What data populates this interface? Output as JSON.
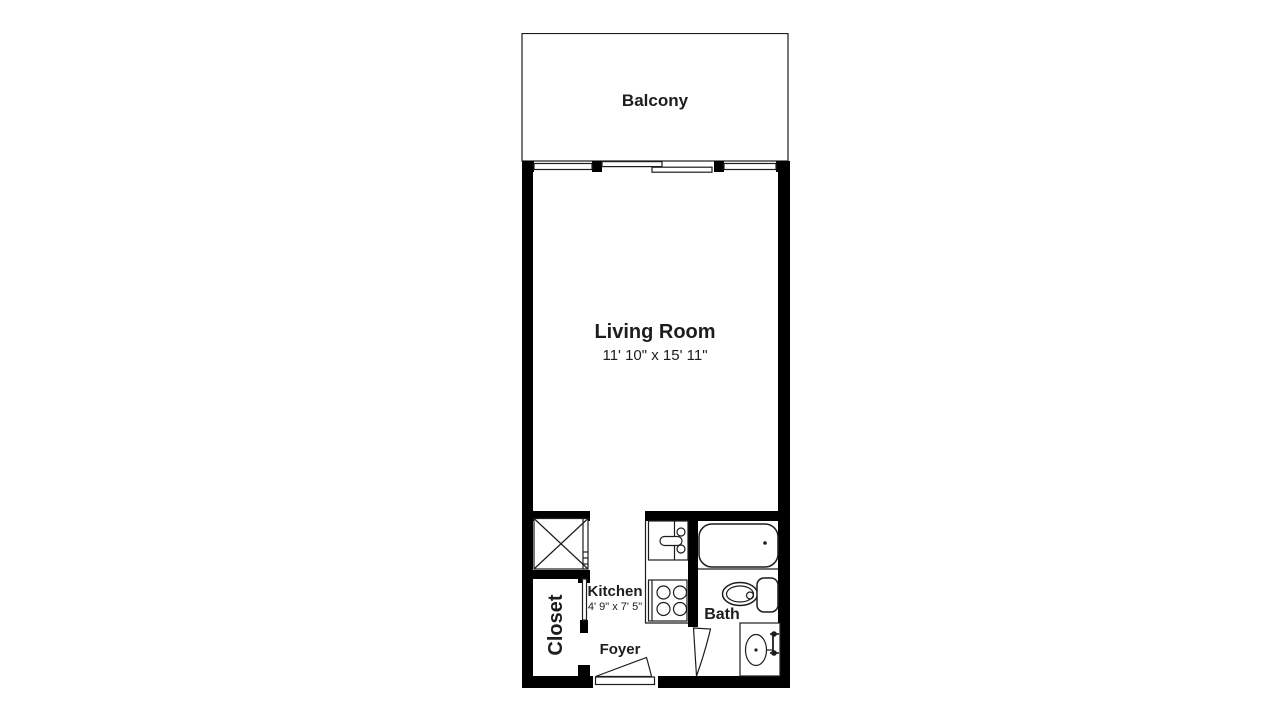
{
  "plan": {
    "title": "Studio apartment floor plan",
    "colors": {
      "wall": "#000000",
      "line": "#1d1d1d",
      "background": "#ffffff"
    },
    "rooms": {
      "balcony": {
        "label": "Balcony"
      },
      "living_room": {
        "label": "Living Room",
        "dimensions": "11' 10\" x 15' 11\""
      },
      "kitchen": {
        "label": "Kitchen",
        "dimensions": "4' 9\" x 7' 5\""
      },
      "foyer": {
        "label": "Foyer"
      },
      "bath": {
        "label": "Bath"
      },
      "closet": {
        "label": "Closet"
      }
    },
    "fixtures": {
      "washer_dryer": "crossed-box-symbol",
      "kitchen_sink": "sink-symbol",
      "stove": "four-burner-stove-symbol",
      "bathtub": "bathtub-symbol",
      "toilet": "toilet-symbol",
      "vanity": "vanity-sink-symbol",
      "entry_door": "door-swing-symbol",
      "bath_door": "door-swing-symbol",
      "balcony_door": "sliding-door-symbol",
      "windows": "window-symbol"
    }
  }
}
